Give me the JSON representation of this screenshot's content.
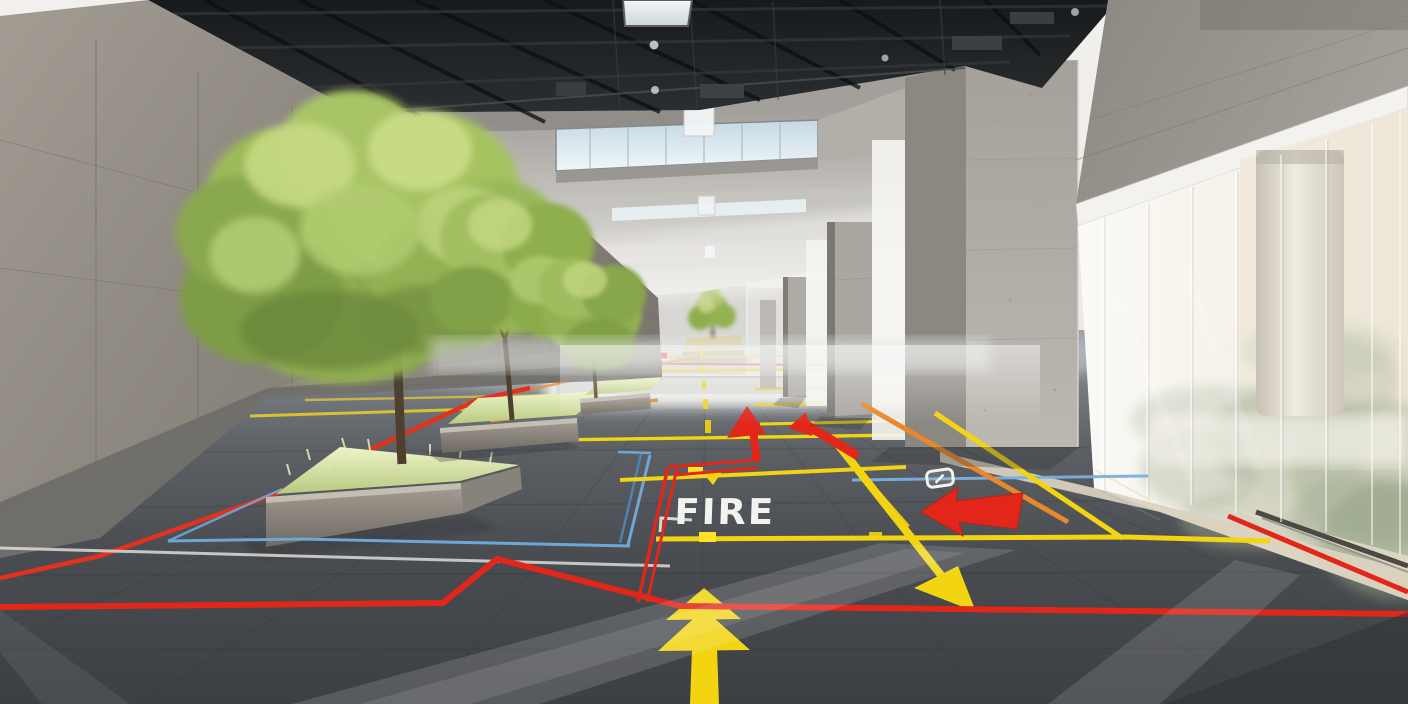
{
  "markings": {
    "fire_label": "FIRE",
    "colors": {
      "yellow": "#f2d411",
      "red": "#e2261a",
      "orange": "#e8872c",
      "blue": "#6ea6d6",
      "white": "#e9e9e4"
    },
    "arrows": [
      {
        "name": "yellow-up-arrow",
        "color": "yellow",
        "direction": "up"
      },
      {
        "name": "yellow-diagonal-arrow",
        "color": "yellow",
        "direction": "down-right"
      },
      {
        "name": "yellow-small-arrow",
        "color": "yellow",
        "direction": "down"
      },
      {
        "name": "red-left-arrow",
        "color": "red",
        "direction": "left"
      },
      {
        "name": "red-up-arrow",
        "color": "red",
        "direction": "up"
      },
      {
        "name": "red-diagonal-arrow",
        "color": "red",
        "direction": "down-left"
      },
      {
        "name": "red-distant-arrow",
        "color": "red",
        "direction": "left"
      }
    ],
    "door_symbol": {
      "shape": "rounded-rectangle-outline",
      "color": "white"
    }
  }
}
